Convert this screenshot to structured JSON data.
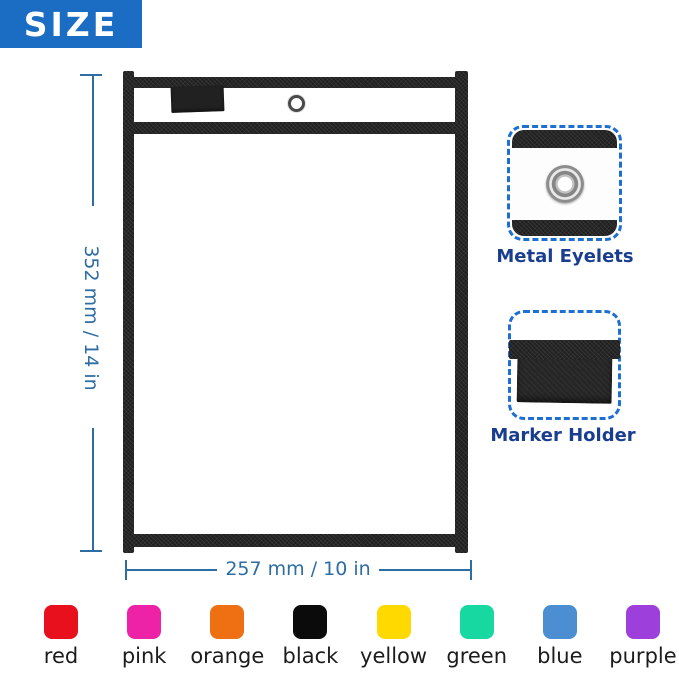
{
  "banner": {
    "label": "SIZE"
  },
  "dimensions": {
    "height_label": "352 mm / 14 in",
    "width_label": "257 mm / 10 in"
  },
  "callouts": {
    "eyelet": {
      "label": "Metal Eyelets"
    },
    "marker": {
      "label": "Marker Holder"
    }
  },
  "colors": [
    {
      "name": "red",
      "hex": "#e8101c"
    },
    {
      "name": "pink",
      "hex": "#ed22a7"
    },
    {
      "name": "orange",
      "hex": "#ee7012"
    },
    {
      "name": "black",
      "hex": "#0b0b0b"
    },
    {
      "name": "yellow",
      "hex": "#ffd900"
    },
    {
      "name": "green",
      "hex": "#17d8a0"
    },
    {
      "name": "blue",
      "hex": "#4b8fd2"
    },
    {
      "name": "purple",
      "hex": "#9d3fdb"
    }
  ],
  "accents": {
    "banner_blue": "#1a6dc3",
    "dimension_blue": "#2e6da4",
    "label_navy": "#1a3e8f",
    "dashed_blue": "#1e6fd2"
  }
}
